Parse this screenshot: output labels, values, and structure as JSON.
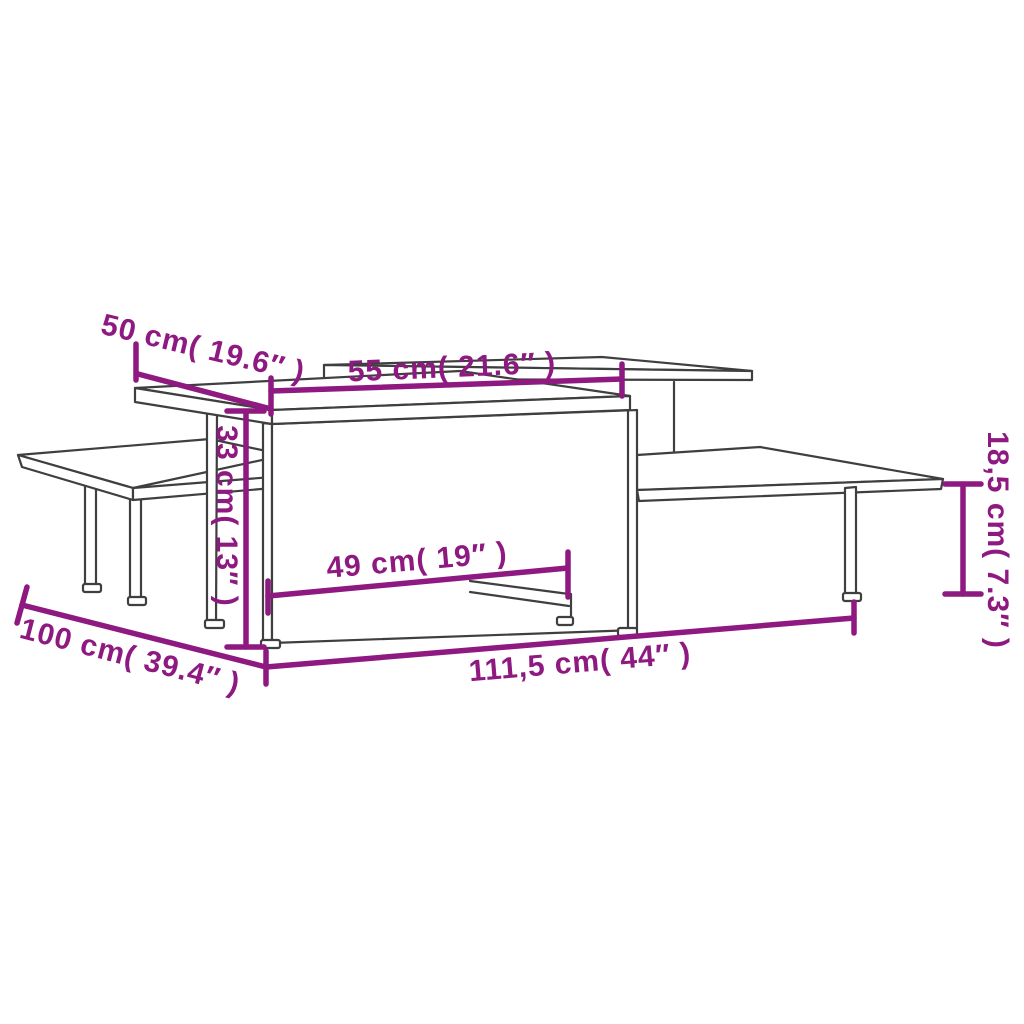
{
  "figure": {
    "type": "furniture-dimension-diagram",
    "subject": "two-piece tiered coffee table set, line drawing with measurements",
    "accent_color": "#8E1980",
    "line_color": "#3f3f3f",
    "background_color": "#ffffff"
  },
  "dimensions": {
    "depth_top": "50 cm( 19.6″ )",
    "width_upper_shelf": "55 cm( 21.6″ )",
    "height_tall": "33 cm( 13″ )",
    "width_inner": "49 cm( 19″ )",
    "height_low": "18,5 cm( 7.3″ )",
    "depth_total": "100 cm( 39.4″ )",
    "width_total": "111,5 cm( 44″ )"
  }
}
